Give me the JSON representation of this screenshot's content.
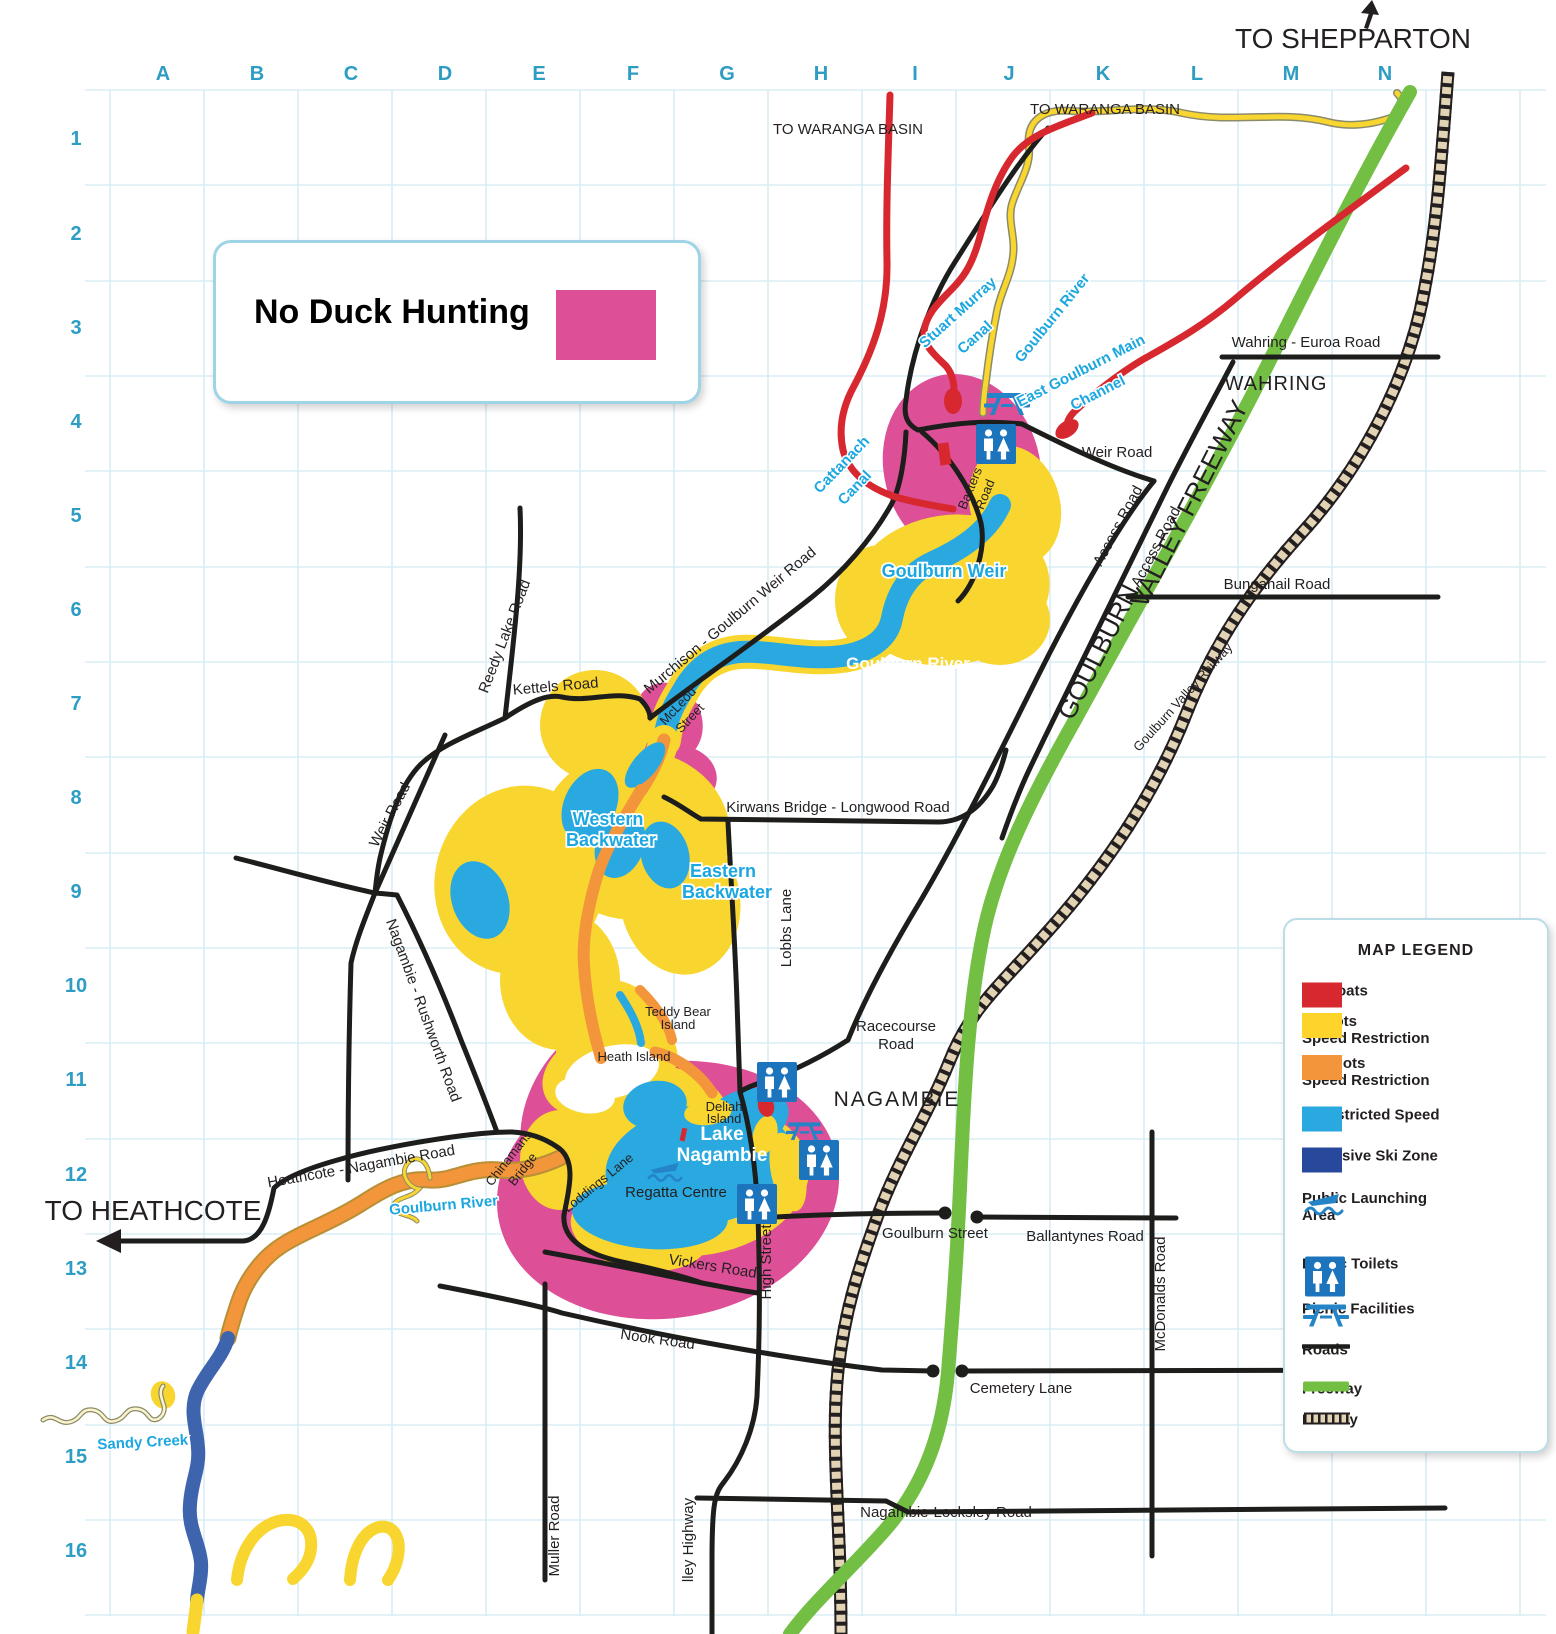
{
  "colors": {
    "pink": "#dd4f96",
    "red": "#d7282f",
    "yellow": "#f8d62f",
    "orange": "#f3953b",
    "blue": "#2aa9e0",
    "dark_blue": "#3f64ae",
    "green": "#72bf44",
    "road": "#1d1d1b",
    "grid": "#d9edf3",
    "grid_label": "#2d9dc3",
    "water_label": "#1ba7e0",
    "rail_tie": "#e2d3b4",
    "text": "#231f20"
  },
  "grid": {
    "cols": [
      "A",
      "B",
      "C",
      "D",
      "E",
      "F",
      "G",
      "H",
      "I",
      "J",
      "K",
      "L",
      "M",
      "N"
    ],
    "rows": [
      "1",
      "2",
      "3",
      "4",
      "5",
      "6",
      "7",
      "8",
      "9",
      "10",
      "11",
      "12",
      "13",
      "14",
      "15",
      "16"
    ]
  },
  "no_duck": {
    "label": "No Duck Hunting",
    "swatch_color": "#dd4f96"
  },
  "legend": {
    "title": "MAP LEGEND",
    "items": [
      {
        "label": "No Boats",
        "type": "swatch",
        "color": "#d7282f"
      },
      {
        "label": "5 Knots",
        "label2": "Speed Restriction",
        "type": "swatch",
        "color": "#fdd32c"
      },
      {
        "label": "20 Knots",
        "label2": "Speed Restriction",
        "type": "swatch",
        "color": "#f3953b"
      },
      {
        "label": "Unrestricted Speed",
        "type": "swatch",
        "color": "#2aa9e0"
      },
      {
        "label": "Exclusive Ski Zone",
        "type": "swatch",
        "color": "#27489b"
      },
      {
        "label": "Public Launching",
        "label2": "Area",
        "type": "boat-icon"
      },
      {
        "label": "Public Toilets",
        "type": "toilet-icon"
      },
      {
        "label": "Picnic Facilities",
        "type": "picnic-icon"
      },
      {
        "label": "Roads",
        "type": "road-line",
        "color": "#1d1d1b"
      },
      {
        "label": "Freeway",
        "type": "freeway-line",
        "color": "#72bf44"
      },
      {
        "label": "Railway",
        "type": "railway-line"
      }
    ]
  },
  "labels": {
    "to_shepparton": "TO SHEPPARTON",
    "to_waranga_a": "TO WARANGA BASIN",
    "to_waranga_b": "TO WARANGA BASIN",
    "to_heathcote": "TO HEATHCOTE",
    "wahring": "WAHRING",
    "nagambie": "NAGAMBIE",
    "wahring_euroa_road": "Wahring - Euroa Road",
    "bunganail_road": "Bunganail Road",
    "weir_road_east": "Weir Road",
    "access_road_a": "Access Road",
    "access_road_b": "Access Road",
    "fwy_goulburn": "GOULBURN",
    "fwy_valley": "VALLEY FREEWAY",
    "gv_railway": "Goulburn Valley Railway",
    "stuart_murray_1": "Stuart Murray",
    "stuart_murray_2": "Canal",
    "cattanach_1": "Cattanach",
    "cattanach_2": "Canal",
    "goulburn_river_upper": "Goulburn River",
    "east_goulburn_1": "East Goulburn Main",
    "east_goulburn_2": "Channel",
    "goulburn_weir": "Goulburn Weir",
    "goulburn_river_mid": "Goulburn River",
    "baxters_1": "Baxters",
    "baxters_2": "Road",
    "mcleod_1": "McLeod",
    "mcleod_2": "Street",
    "murchison_road": "Murchison - Goulburn Weir Road",
    "kettels_road": "Kettels Road",
    "reedy_lake_road": "Reedy Lake Road",
    "weir_road_west": "Weir Road",
    "kirwans_road": "Kirwans Bridge - Longwood Road",
    "lobbs_lane": "Lobbs Lane",
    "western_1": "Western",
    "western_2": "Backwater",
    "eastern_1": "Eastern",
    "eastern_2": "Backwater",
    "nagambie_rushworth": "Nagambie - Rushworth Road",
    "racecourse_1": "Racecourse",
    "racecourse_2": "Road",
    "teddy_1": "Teddy Bear",
    "teddy_2": "Island",
    "heath_island": "Heath Island",
    "deliah_1": "Deliah",
    "deliah_2": "Island",
    "lake_1": "Lake",
    "lake_2": "Nagambie",
    "regatta": "Regatta Centre",
    "chinamans_1": "Chinamans",
    "chinamans_2": "Bridge",
    "loddings_lane": "Loddings Lane",
    "goulburn_river_west": "Goulburn River",
    "heathcote_nagambie_road": "Heathcote - Nagambie Road",
    "high_street": "High Street",
    "goulburn_street": "Goulburn Street",
    "ballantynes_road": "Ballantynes Road",
    "mcdonalds_road": "McDonalds Road",
    "vickers_road": "Vickers Road",
    "nook_road": "Nook Road",
    "cemetery_lane": "Cemetery Lane",
    "nagambie_locksley_road": "Nagambie-Locksley Road",
    "muller_road": "Muller Road",
    "valley_highway": "lley Highway",
    "sandy_creek": "Sandy Creek"
  }
}
